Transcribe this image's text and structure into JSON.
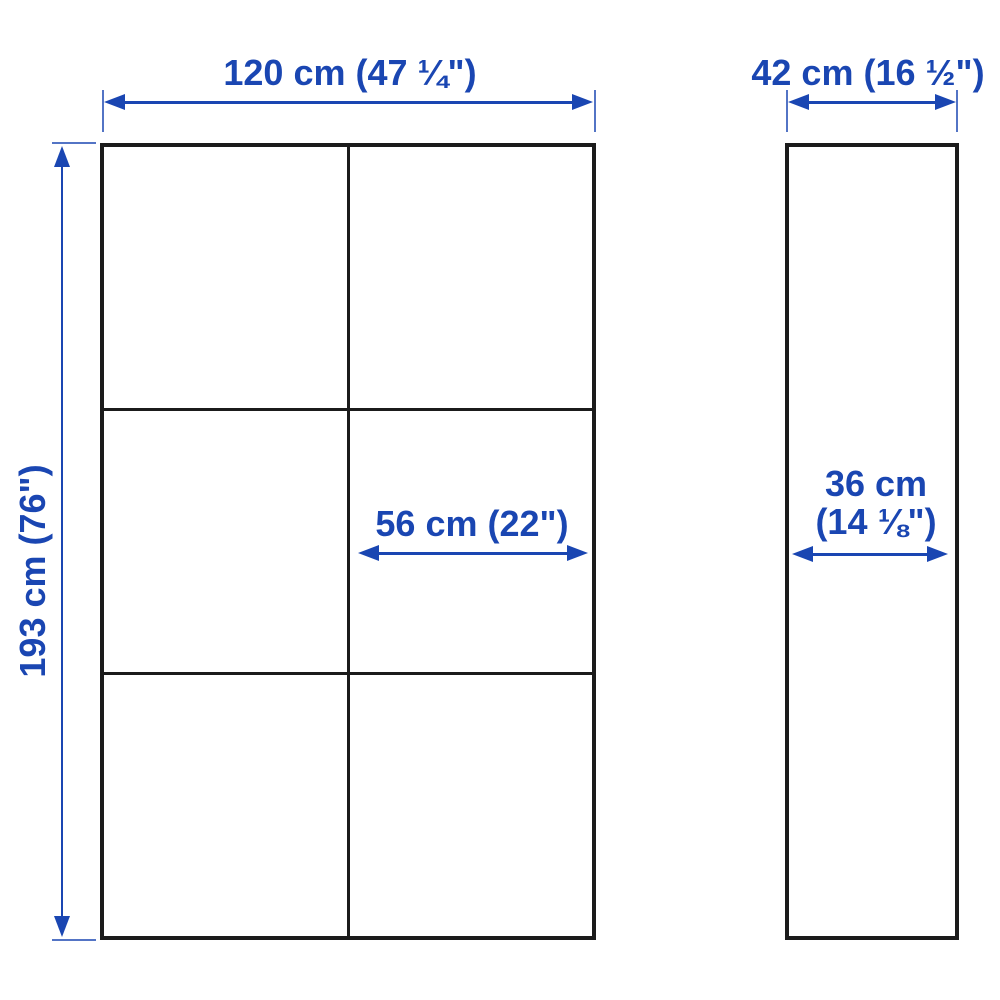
{
  "diagram": {
    "type": "furniture-dimension-diagram",
    "views": {
      "front": {
        "description": "front view of storage cabinet, 2 columns x 3 rows of sections",
        "columns": 2,
        "rows": 3
      },
      "side": {
        "description": "side (depth) view of cabinet"
      }
    },
    "labels": {
      "front_width": "120 cm (47 ¼\")",
      "front_height": "193 cm (76\")",
      "section_width": "56 cm (22\")",
      "side_depth": "42 cm (16 ½\")",
      "side_inner_depth_line1": "36 cm",
      "side_inner_depth_line2": "(14 ⅛\")"
    },
    "colors": {
      "dimension_blue": "#1a46b2",
      "outline_dark": "#1b1b1b",
      "background": "#ffffff"
    }
  }
}
